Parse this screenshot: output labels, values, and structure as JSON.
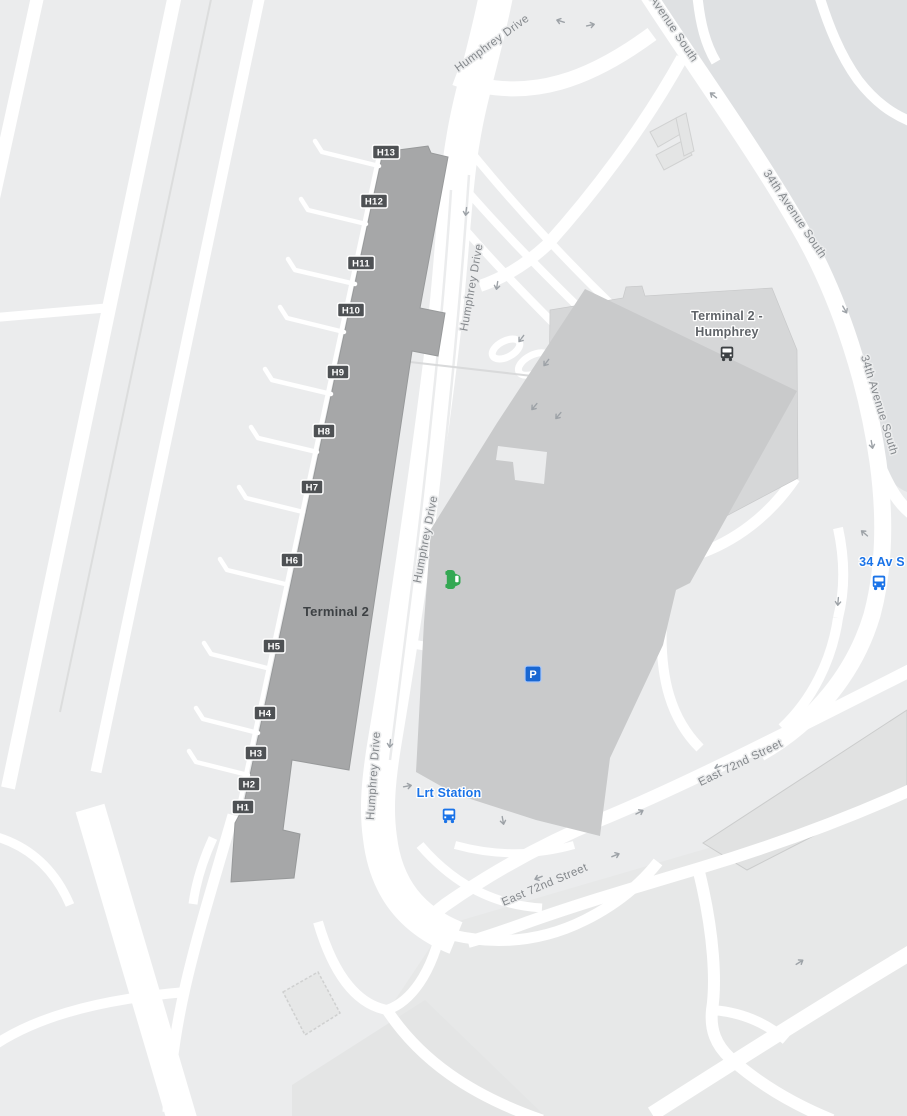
{
  "map": {
    "terminal": {
      "label": "Terminal 2"
    },
    "gates": [
      {
        "id": "H1"
      },
      {
        "id": "H2"
      },
      {
        "id": "H3"
      },
      {
        "id": "H4"
      },
      {
        "id": "H5"
      },
      {
        "id": "H6"
      },
      {
        "id": "H7"
      },
      {
        "id": "H8"
      },
      {
        "id": "H9"
      },
      {
        "id": "H10"
      },
      {
        "id": "H11"
      },
      {
        "id": "H12"
      },
      {
        "id": "H13"
      }
    ],
    "road_labels": [
      {
        "text": "Humphrey Drive"
      },
      {
        "text": "Humphrey Drive"
      },
      {
        "text": "Humphrey Drive"
      },
      {
        "text": "Humphrey Drive"
      },
      {
        "text": "Avenue South"
      },
      {
        "text": "34th Avenue South"
      },
      {
        "text": "34th Avenue South"
      },
      {
        "text": "East 72nd Street"
      },
      {
        "text": "East 72nd Street"
      }
    ],
    "transit_stops": [
      {
        "line1": "Terminal 2 -",
        "line2": "Humphrey",
        "color": "#5f6368"
      },
      {
        "line1": "34 Av S",
        "color": "#1a73e8"
      },
      {
        "line1": "Lrt Station",
        "color": "#1a73e8"
      }
    ],
    "parking": {
      "label": "P"
    },
    "colors": {
      "background": "#ebeced",
      "road": "#ffffff",
      "terminal_fill": "#a6a7a8",
      "building_front": "#c9cacb",
      "building_back": "#d6d7d8",
      "terrain_dark": "#dfe1e3",
      "transit_blue": "#1a73e8",
      "parking_blue": "#1967d2",
      "pickup_green": "#34a853",
      "gate_badge": "#4e5154"
    }
  }
}
